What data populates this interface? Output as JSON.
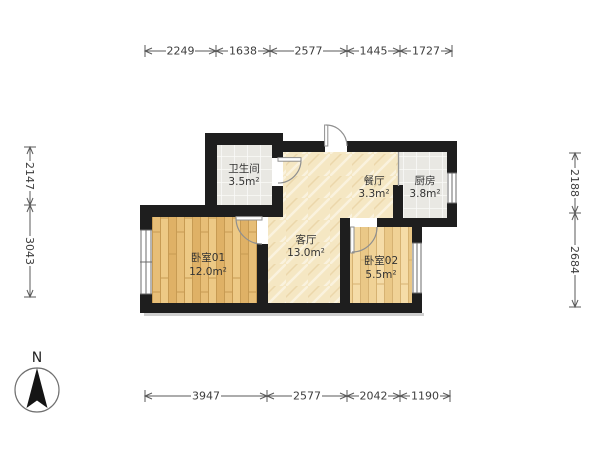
{
  "page": {
    "background": "#ffffff"
  },
  "compass": {
    "label": "N"
  },
  "rooms": [
    {
      "id": "bathroom",
      "name": "卫生间",
      "area": "3.5m²"
    },
    {
      "id": "dining-room",
      "name": "餐厅",
      "area": "3.3m²"
    },
    {
      "id": "kitchen",
      "name": "厨房",
      "area": "3.8m²"
    },
    {
      "id": "living-room",
      "name": "客厅",
      "area": "13.0m²"
    },
    {
      "id": "bedroom-01",
      "name": "卧室01",
      "area": "12.0m²"
    },
    {
      "id": "bedroom-02",
      "name": "卧室02",
      "area": "5.5m²"
    }
  ],
  "dimensions_mm": {
    "top": [
      "2249",
      "1638",
      "2577",
      "1445",
      "1727"
    ],
    "bottom": [
      "3947",
      "2577",
      "2042",
      "1190"
    ],
    "left": [
      "2147",
      "3043"
    ],
    "right": [
      "2188",
      "2684"
    ]
  },
  "colors": {
    "wall": "#1e1e1e",
    "tile_floor": "#e9e8e3",
    "living_floor": "#f5e7c3",
    "bedroom01_floor": "#e7be77",
    "bedroom02_floor": "#f0d296",
    "dimension_text": "#3d3d3d"
  }
}
